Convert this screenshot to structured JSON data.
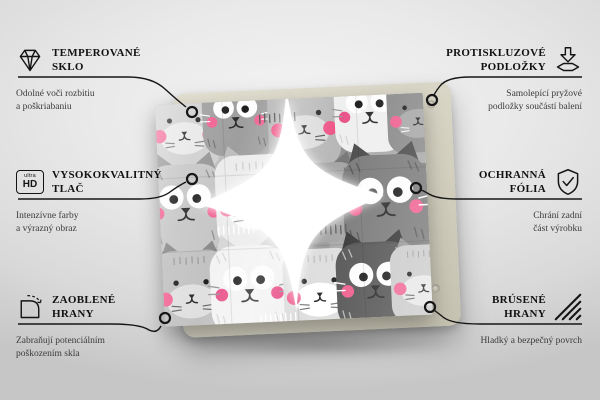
{
  "features_left": [
    {
      "title": "TEMPEROVANÉ\nSKLO",
      "description": "Odolné voči rozbitiu\na poškriabaniu",
      "icon": "diamond-icon"
    },
    {
      "title": "VYSOKOKVALITNÝ\nTLAČ",
      "description": "Intenzívne farby\na výrazný obraz",
      "icon": "ultra-hd-icon",
      "icon_label_top": "ultra",
      "icon_label_bottom": "HD"
    },
    {
      "title": "ZAOBLENÉ\nHRANY",
      "description": "Zabraňují potenciálním\npoškozením skla",
      "icon": "rounded-corner-icon"
    }
  ],
  "features_right": [
    {
      "title": "PROTISKLUZOVÉ\nPODLOŽKY",
      "description": "Samolepící pryžové\npodložky součástí balení",
      "icon": "anti-slip-pads-icon"
    },
    {
      "title": "OCHRANNÁ\nFÓLIA",
      "description": "Chrání zadní\nčást výrobku",
      "icon": "shield-check-icon"
    },
    {
      "title": "BRÚSENÉ\nHRANY",
      "description": "Hladký a bezpečný povrch",
      "icon": "brushed-edges-icon"
    }
  ],
  "product": {
    "name": "tempered-glass-board-with-cat-pattern-print",
    "backing_color": "#d6d3c3",
    "pattern_background": "#a9a9a9",
    "accent_pink": "#f06292",
    "accent_pink_deep": "#ee5587"
  },
  "colors": {
    "line": "#161616",
    "title_text": "#121212",
    "description_text": "#3b3b3b",
    "background_light": "#f4f4f4",
    "background_dark": "#c6c6c6"
  }
}
